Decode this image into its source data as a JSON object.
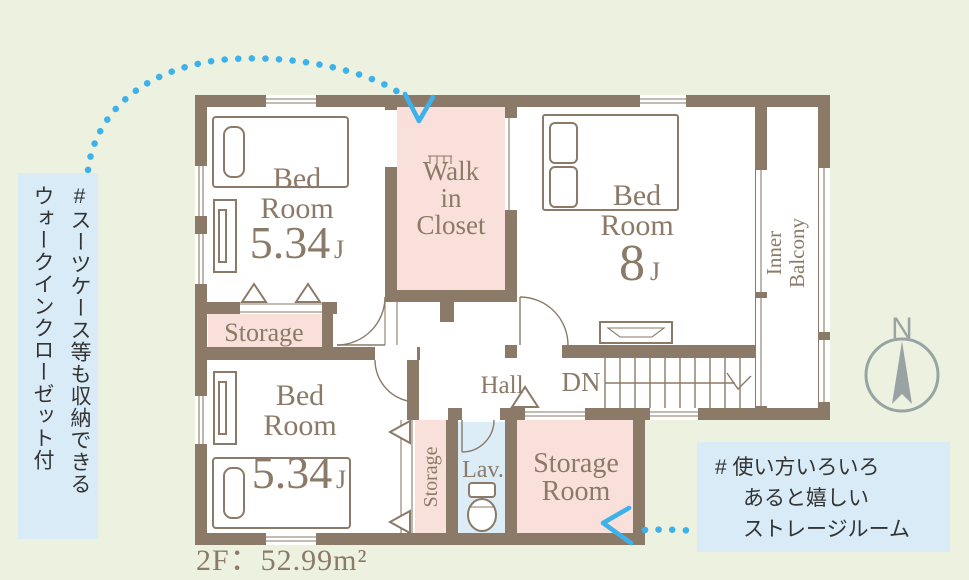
{
  "colors": {
    "background": "#edf1e0",
    "wall_brown": "#8a7a67",
    "room_pink": "#f9e0da",
    "callout_blue": "#d8ebf7",
    "lavatory_blue": "#dcedf8",
    "arrow_blue": "#3db1e9",
    "compass_gray": "#9aa3a3",
    "callout_text": "#333333"
  },
  "plan": {
    "floor_area_label": "2F：52.99m²",
    "rooms": {
      "bedroom_top_left": {
        "line1": "Bed",
        "line2": "Room",
        "size": "5.34",
        "unit": "J"
      },
      "walk_in_closet": {
        "line1": "Walk",
        "line2": "in",
        "line3": "Closet"
      },
      "bedroom_right": {
        "line1": "Bed",
        "line2": "Room",
        "size": "8",
        "unit": "J"
      },
      "bedroom_bottom_left": {
        "line1": "Bed",
        "line2": "Room",
        "size": "5.34",
        "unit": "J"
      },
      "inner_balcony": {
        "line1": "Inner",
        "line2": "Balcony"
      },
      "storage_closet": {
        "label": "Storage"
      },
      "storage_column": {
        "label": "Storage"
      },
      "lavatory": {
        "label": "Lav."
      },
      "storage_room": {
        "line1": "Storage",
        "line2": "Room"
      },
      "hall": {
        "label": "Hall"
      },
      "stairs": {
        "label": "DN"
      }
    },
    "compass": {
      "label": "N"
    }
  },
  "callouts": {
    "walk_in_closet_note": {
      "column1": "#スーツケース等も収納できる",
      "column2": "ウォークインクローゼット付"
    },
    "storage_room_note": {
      "line1": "# 使い方いろいろ",
      "line2": "あると嬉しい",
      "line3": "ストレージルーム"
    }
  }
}
